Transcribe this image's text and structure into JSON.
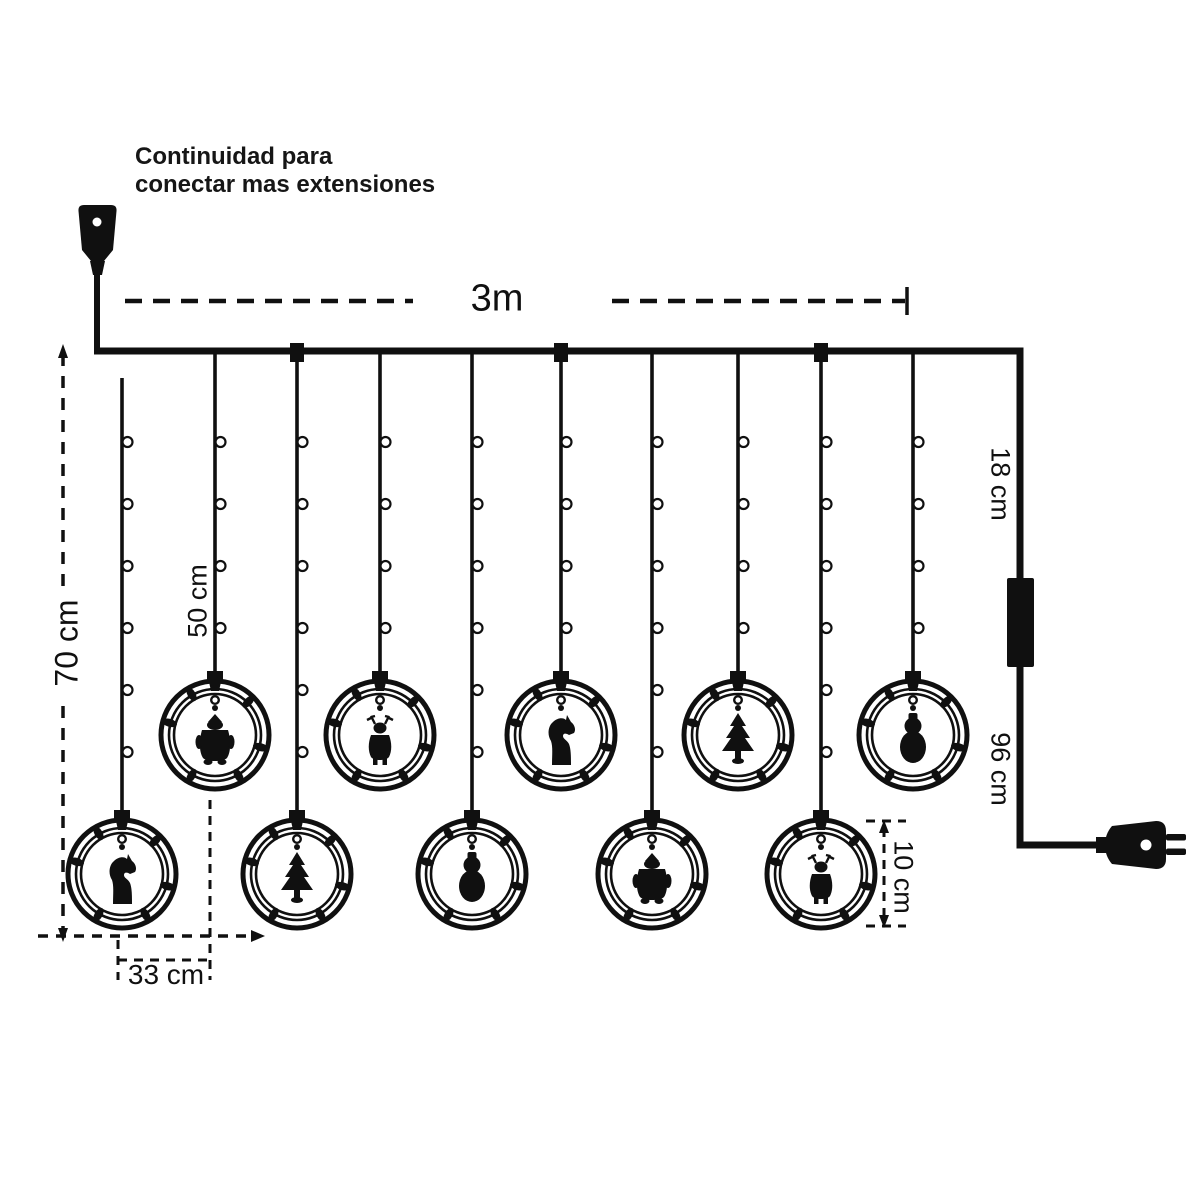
{
  "note": {
    "line1": "Continuidad para",
    "line2": "conectar mas extensiones"
  },
  "dimensions": {
    "total_width": "3m",
    "left_drop": "70 cm",
    "short_drop": "50 cm",
    "drop_spacing": "33 cm",
    "lead_top": "18 cm",
    "lead_bottom": "96 cm",
    "ring_diameter": "10 cm"
  },
  "colors": {
    "line": "#101010",
    "background": "#ffffff"
  },
  "strings": [
    {
      "x": 122,
      "row": "long",
      "figure": "rocking-horse",
      "gap_top": true
    },
    {
      "x": 215,
      "row": "short",
      "figure": "santa"
    },
    {
      "x": 297,
      "row": "long",
      "figure": "christmas-tree",
      "tap": true
    },
    {
      "x": 380,
      "row": "short",
      "figure": "reindeer"
    },
    {
      "x": 472,
      "row": "long",
      "figure": "snowman"
    },
    {
      "x": 561,
      "row": "short",
      "figure": "rocking-horse",
      "tap": true
    },
    {
      "x": 652,
      "row": "long",
      "figure": "santa"
    },
    {
      "x": 738,
      "row": "short",
      "figure": "christmas-tree"
    },
    {
      "x": 821,
      "row": "long",
      "figure": "reindeer",
      "tap": true
    },
    {
      "x": 913,
      "row": "short",
      "figure": "snowman"
    }
  ]
}
